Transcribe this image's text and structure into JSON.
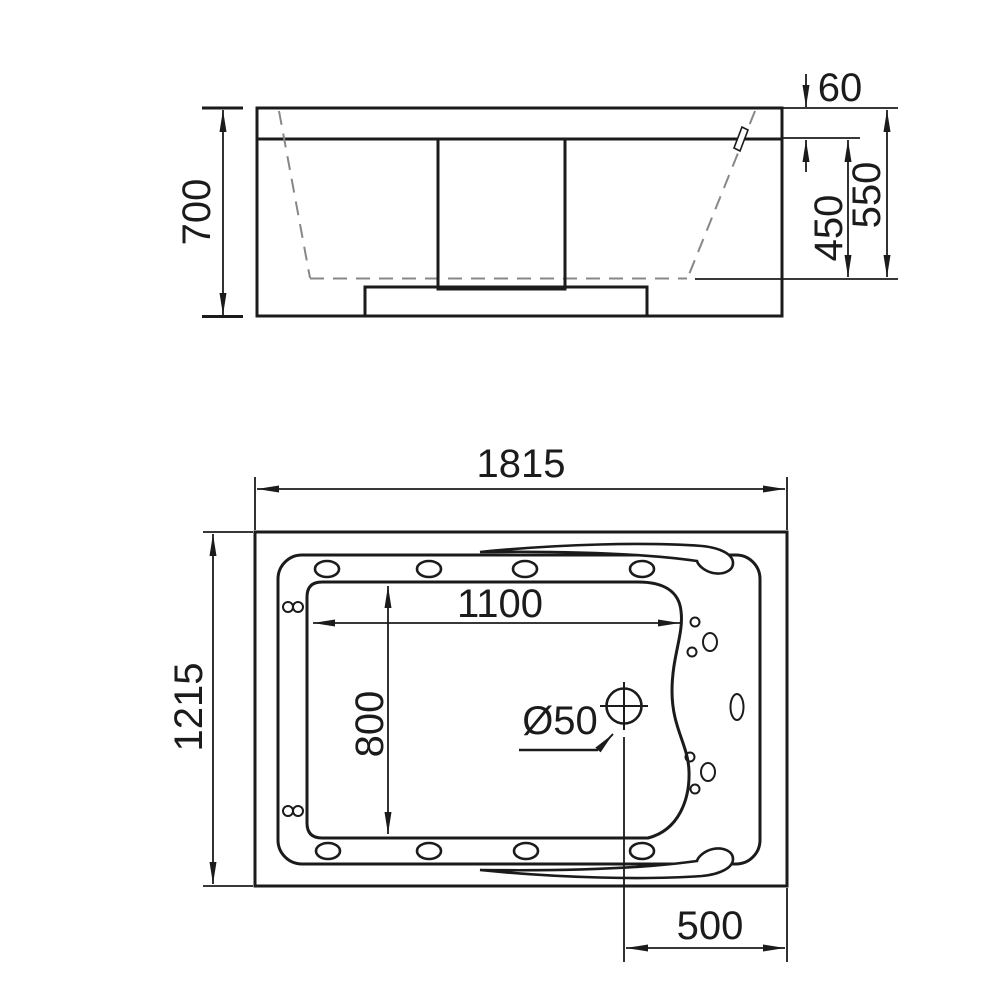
{
  "drawing": {
    "type": "bathtub-technical-drawing",
    "colors": {
      "line": "#1b1b1b",
      "dashed_line": "#878787",
      "background": "#ffffff"
    },
    "side_view": {
      "total_height": "700",
      "rim_height": "60",
      "inner_depth": "450",
      "overall_depth": "550"
    },
    "plan_view": {
      "overall_length": "1815",
      "overall_width": "1215",
      "basin_length": "1100",
      "basin_width": "800",
      "drain_diameter": "Ø50",
      "drain_offset": "500"
    }
  }
}
